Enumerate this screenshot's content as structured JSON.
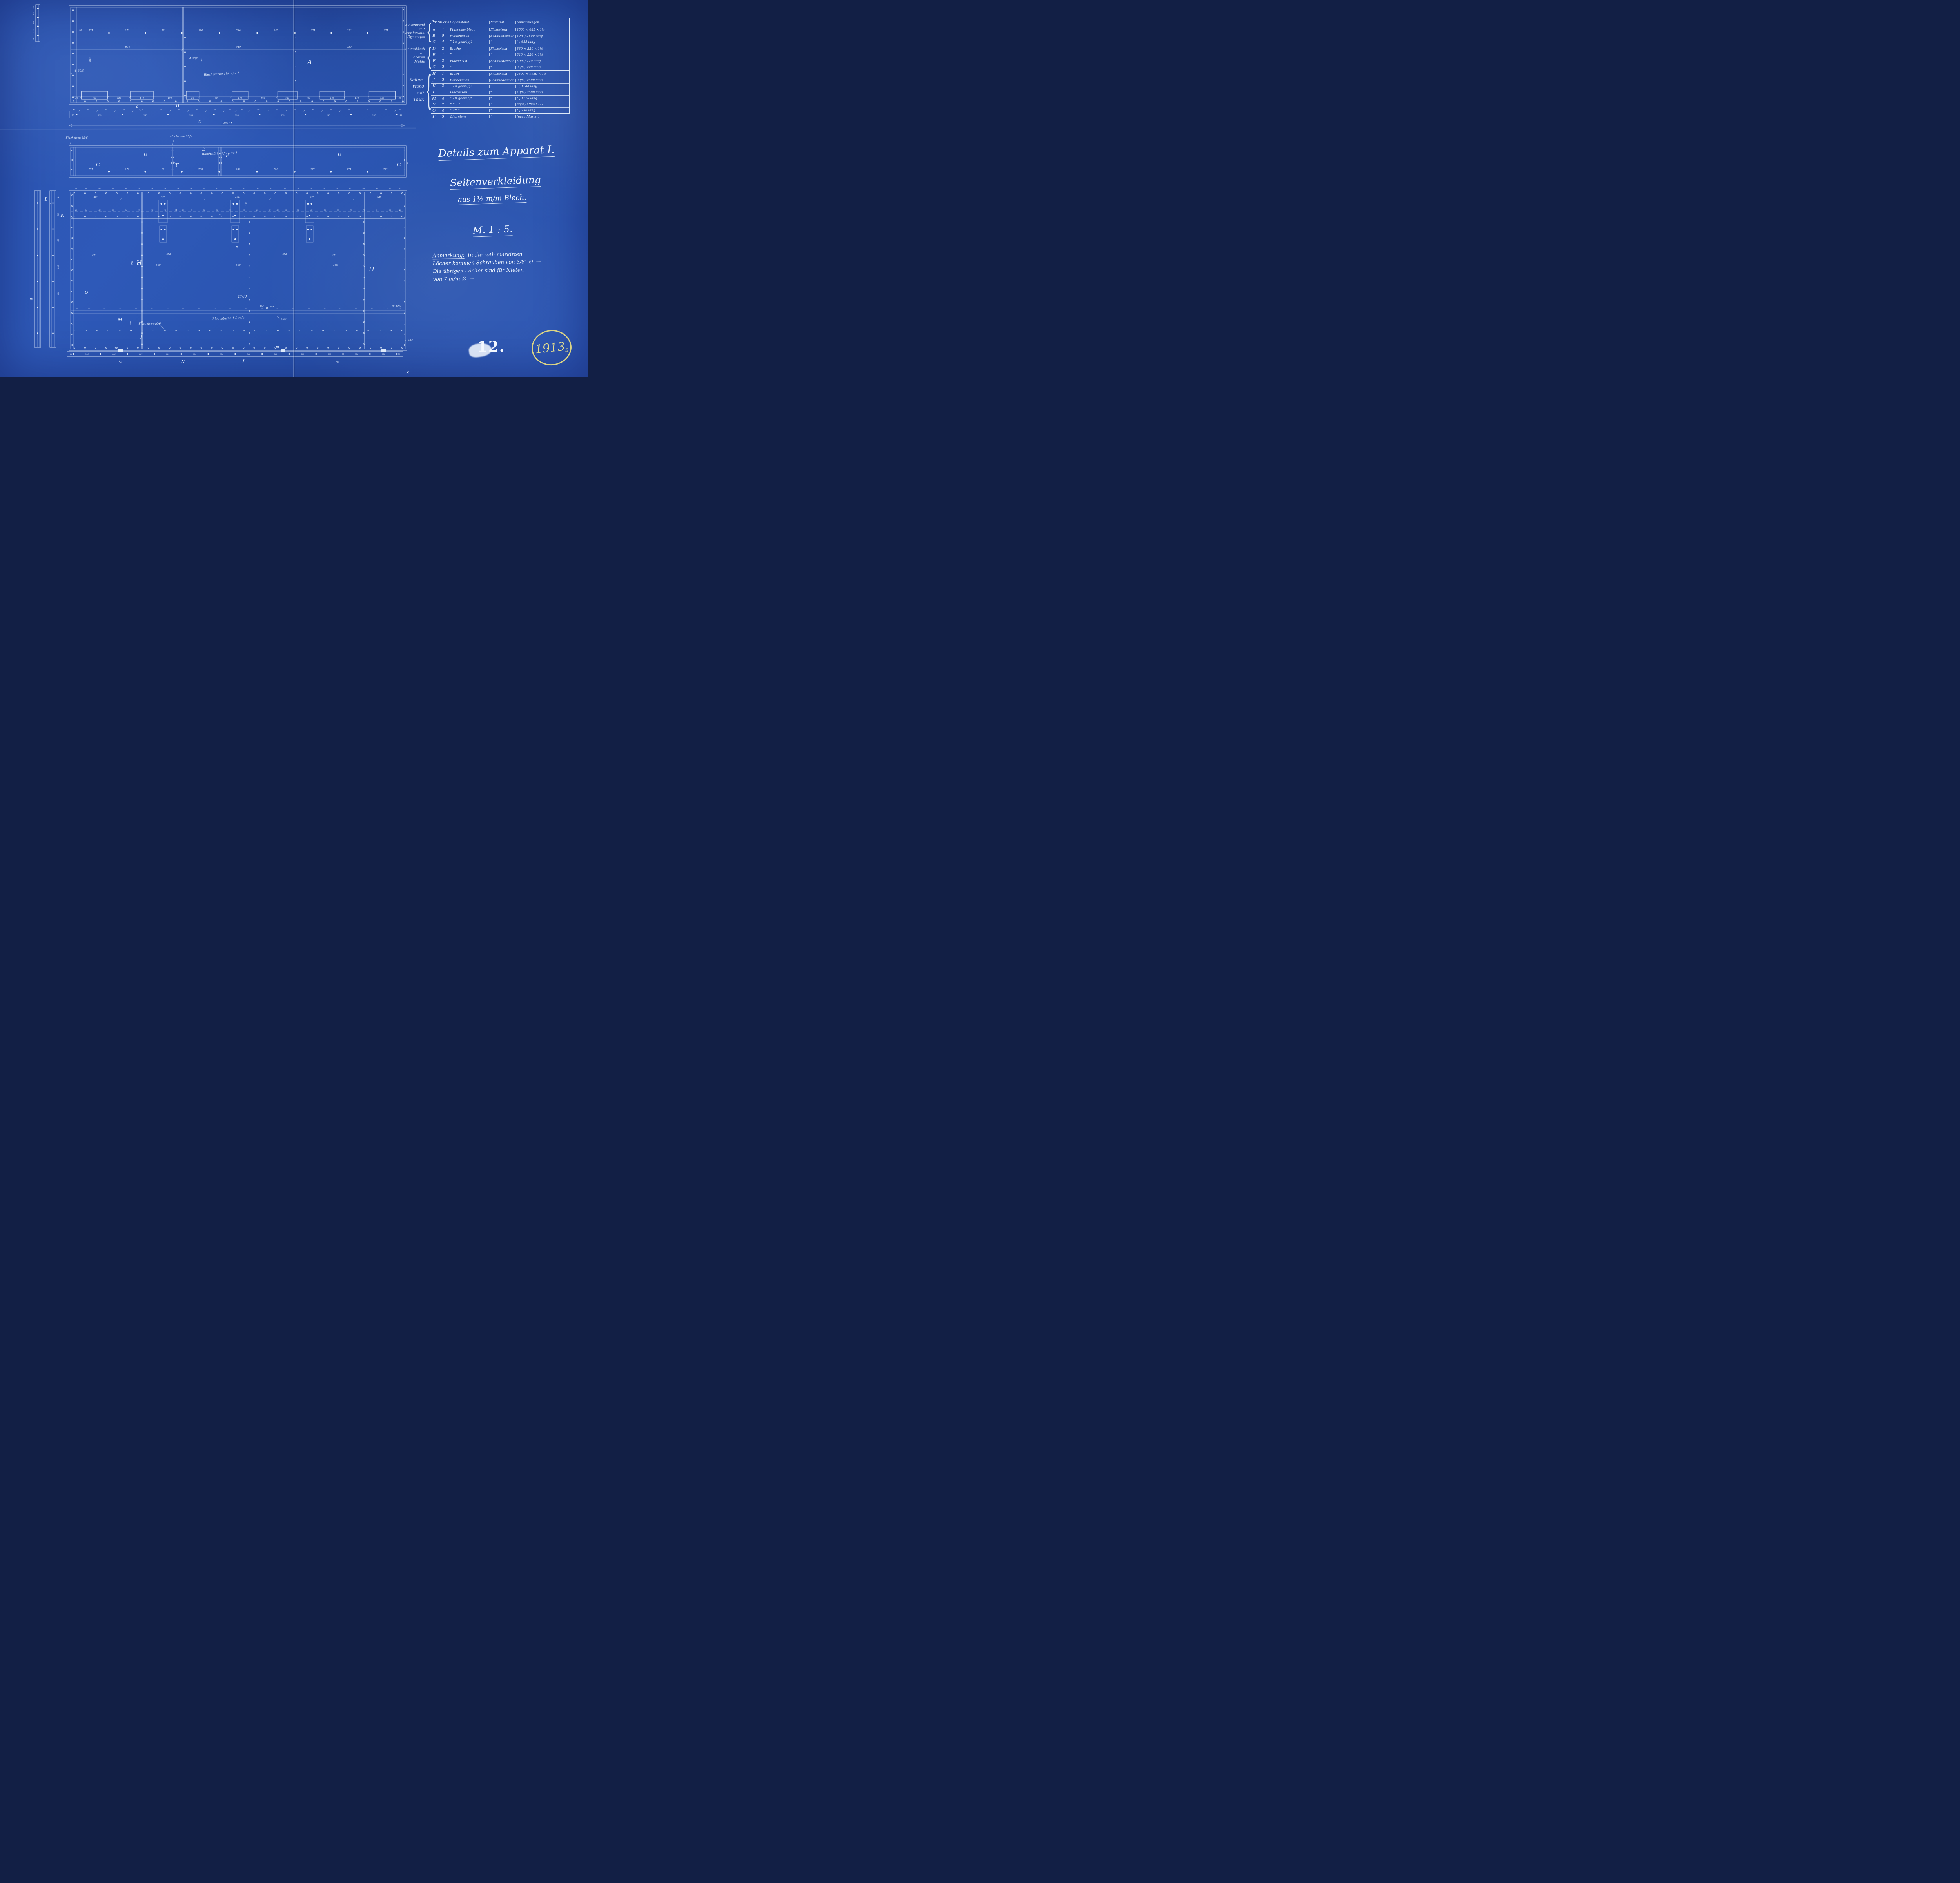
{
  "page": {
    "number": "12.",
    "stamp_year": "1913",
    "stamp_suffix": "s"
  },
  "title_block": {
    "line1": "Details zum Apparat I.",
    "line2": "Seitenverkleidung",
    "line3": "aus 1½ m/m Blech.",
    "scale": "M. 1 : 5."
  },
  "note": {
    "label": "Anmerkung:",
    "lines": [
      "In die roth markirten",
      "Löcher kommen Schrauben von 3/8″ ∅. —",
      "Die übrigen Löcher sind für Nieten",
      "von 7 m/m ∅. —"
    ]
  },
  "table": {
    "headers": {
      "pos": "Pos.",
      "qty": "Stück-zahl",
      "item": "Gegenstand:",
      "material": "Material.",
      "notes": "Anmerkungen."
    },
    "groups": [
      {
        "lines": [
          "Seitenwand",
          "mit",
          "Ventilations-",
          "Öffnungen"
        ]
      },
      {
        "lines": [
          "Seitenblech",
          "zur",
          "oberen",
          "Mulde"
        ]
      },
      {
        "lines": [
          "Seiten-",
          "Wand",
          "mit",
          "Thür."
        ]
      }
    ],
    "rows": [
      {
        "pos": "a",
        "qty": "1",
        "item": "Flusseisenblech",
        "material": "Flusseisen",
        "notes": "2500 × 685 × 1½"
      },
      {
        "pos": "B",
        "qty": "5",
        "item": "Winkeleisen",
        "material": "Schmiedeeisen",
        "notes": "30/6 ; 2500 lang"
      },
      {
        "pos": "C",
        "qty": "4",
        "item": "”  1× gekröpft",
        "material": "”",
        "notes": "” ; 685 lang"
      },
      {
        "pos": "D",
        "qty": "2",
        "item": "Bleche",
        "material": "Flusseisen",
        "notes": "830 × 220 × 1½"
      },
      {
        "pos": "E",
        "qty": "1",
        "item": "”",
        "material": "”",
        "notes": "840 × 220 × 1½"
      },
      {
        "pos": "F",
        "qty": "2",
        "item": "Flacheisen",
        "material": "Schmiedeeisen",
        "notes": "50/6 ; 220 lang"
      },
      {
        "pos": "G",
        "qty": "2",
        "item": "”",
        "material": "”",
        "notes": "35/6 ; 220 lang"
      },
      {
        "pos": "H",
        "qty": "1",
        "item": "Blech",
        "material": "Flusseisen",
        "notes": "2500 × 1150 × 1½"
      },
      {
        "pos": "J",
        "qty": "2",
        "item": "Winkeleisen",
        "material": "Schmiedeeisen",
        "notes": "30/6 ; 2500 lang"
      },
      {
        "pos": "K",
        "qty": "2",
        "item": "”  2× gekröpft",
        "material": "”",
        "notes": "” ; 1188 lang"
      },
      {
        "pos": "L",
        "qty": "1",
        "item": "Flacheisen",
        "material": "”",
        "notes": "40/6 ; 2500 lang"
      },
      {
        "pos": "M",
        "qty": "4",
        "item": "”  1× gekröpft",
        "material": "”",
        "notes": "” ; 1170 lang"
      },
      {
        "pos": "N",
        "qty": "2",
        "item": "”  3×  ”",
        "material": "”",
        "notes": "30/6 ; 1780 lang"
      },
      {
        "pos": "O",
        "qty": "4",
        "item": "”  2×  ”",
        "material": "”",
        "notes": "” ; 730 lang"
      },
      {
        "pos": "P",
        "qty": "3",
        "item": "Charniere",
        "material": "”",
        "notes": "(nach Muster)"
      }
    ]
  },
  "labels": {
    "A": "A",
    "B": "B",
    "a": "a",
    "C": "C",
    "G": "G",
    "D": "D",
    "E": "E",
    "F": "F",
    "H": "H",
    "J": "J",
    "K": "K",
    "L": "L",
    "M": "M",
    "N": "N",
    "O": "O",
    "P": "P",
    "m": "m",
    "n": "n"
  },
  "annotations": {
    "blech1": "Blechstärke 1½ m/m !",
    "blech2": "Blechstärke 1½ m/m",
    "flach35": "Flacheisen 35/6",
    "flach50": "Flacheisen 50/6",
    "flach40": "Flacheisen 40/6",
    "a4306": "4· 30/6",
    "a306": "30/6",
    "a406": "40/6",
    "l406": "∟ 40/6"
  },
  "dims": {
    "top_holes": [
      "271",
      "271",
      "271",
      "280",
      "280",
      "280",
      "271",
      "271",
      "271"
    ],
    "top_mid": [
      "830",
      "840",
      "830"
    ],
    "vent": [
      "50",
      "160",
      "130",
      "140",
      "190",
      "80",
      "190",
      "100",
      "170",
      "120",
      "130",
      "150",
      "140",
      "160",
      "50"
    ],
    "stripA_top": [
      "43",
      "80",
      "80",
      "80",
      "80",
      "80",
      "80",
      "80",
      "80",
      "50",
      "60",
      "80",
      "80",
      "80",
      "80",
      "80",
      "80",
      "80",
      "80",
      "43"
    ],
    "stripA_inner": [
      "50",
      "300",
      "300",
      "300",
      "300",
      "300",
      "300",
      "300",
      "50"
    ],
    "mid_holes": [
      "271",
      "271",
      "271",
      "280",
      "280",
      "280",
      "271",
      "271",
      "271"
    ],
    "bigH_top": [
      "43",
      "80",
      "80",
      "80",
      "80",
      "78",
      "78",
      "78",
      "78",
      "78",
      "79",
      "82",
      "82",
      "81",
      "81",
      "82",
      "82",
      "79",
      "78",
      "78",
      "78",
      "80",
      "80",
      "80",
      "80",
      "43"
    ],
    "bigH_door": [
      "43",
      "80",
      "80",
      "80",
      "80",
      "78",
      "78",
      "78",
      "51",
      "30",
      "75",
      "78",
      "78",
      "79",
      "82",
      "82",
      "66",
      "30",
      "66",
      "82",
      "82",
      "79",
      "78",
      "78",
      "75",
      "80",
      "80",
      "43"
    ],
    "bigH_interior": [
      "380",
      "625",
      "490",
      "625",
      "380"
    ],
    "bigH_rail": [
      "43",
      "80",
      "80",
      "80",
      "80",
      "80",
      "80",
      "80",
      "80",
      "80",
      "80",
      "80",
      "80",
      "80",
      "80",
      "80",
      "80",
      "80",
      "80",
      "80",
      "80",
      "43"
    ],
    "bottom_strip": [
      "50",
      "300",
      "300",
      "300",
      "300",
      "300",
      "300",
      "300",
      "300",
      "300",
      "300",
      "300",
      "300",
      "50"
    ],
    "total": "2500",
    "d685": "685",
    "d525": "525",
    "d220": "220",
    "d13": "13",
    "d1700": "1700",
    "d700": "700",
    "d560": "560",
    "d570": "570",
    "d290": "290",
    "d150": "150",
    "d250": "250",
    "d15": "15",
    "d44": "44",
    "d188": "188",
    "tl125": "12.5",
    "tl170": "170",
    "tl145": "145",
    "tl94": "94"
  }
}
